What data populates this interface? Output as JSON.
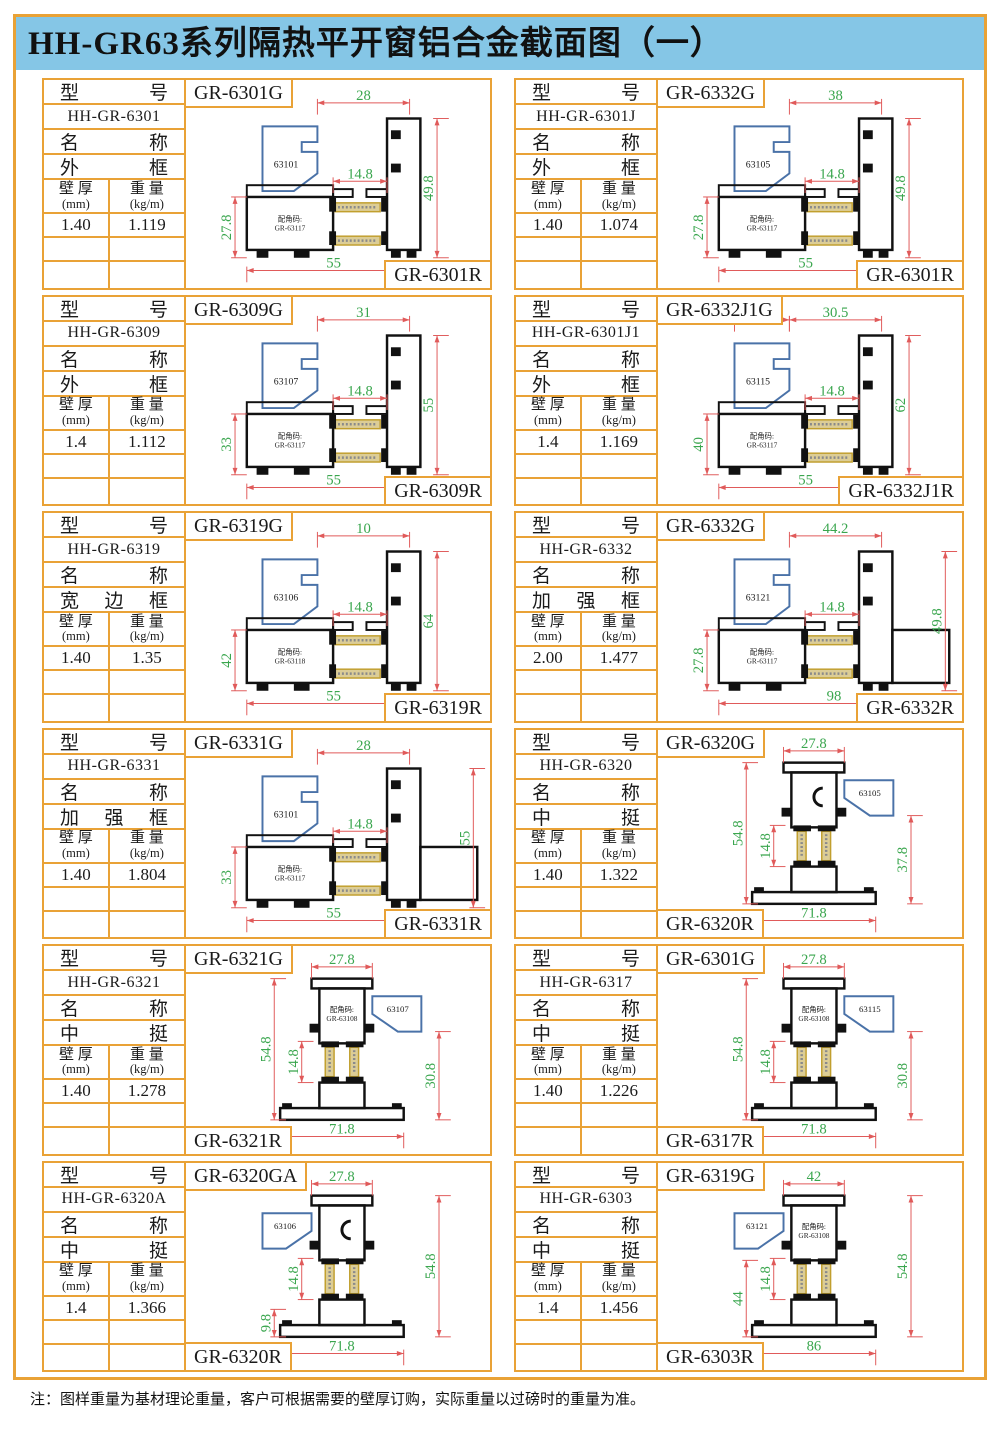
{
  "title": "HH-GR63系列隔热平开窗铝合金截面图（一）",
  "note": "注：图样重量为基材理论重量，客户可根据需要的壁厚订购，实际重量以过磅时的重量为准。",
  "table_labels": {
    "model": "型 号",
    "name": "名 称",
    "thickness_line1": "壁 厚",
    "thickness_unit": "(mm)",
    "weight_line1": "重 量",
    "weight_unit": "(kg/m)"
  },
  "drawing_labels": {
    "corner_label": "配角码:"
  },
  "colors": {
    "border": "#E9A236",
    "title_bg": "#85C6E6",
    "text": "#1a1a1a",
    "profile": "#111111",
    "bead": "#4A72A8",
    "dim_line": "#E05A5A",
    "dim_text": "#3AA64E",
    "thermo_fill": "#DCCD96",
    "thermo_stroke": "#C19F2E",
    "thermo_dots": "#8A8A8A"
  },
  "cells": [
    {
      "model": "HH-GR-6301",
      "name": "外 框",
      "thickness": "1.40",
      "weight": "1.119",
      "g_label": "GR-6301G",
      "r_label": "GR-6301R",
      "r_pos": "right",
      "drawing": {
        "type": "frame",
        "bead_label": "63101",
        "bead_side": "left",
        "corner_code": "GR-63117",
        "dims": {
          "top": "28",
          "mid": "14.8",
          "left": "27.8",
          "right": "49.8",
          "bottom": "55"
        }
      }
    },
    {
      "model": "HH-GR-6301J",
      "name": "外 框",
      "thickness": "1.40",
      "weight": "1.074",
      "g_label": "GR-6332G",
      "r_label": "GR-6301R",
      "r_pos": "right",
      "drawing": {
        "type": "frame",
        "bead_label": "63105",
        "bead_side": "left",
        "corner_code": "GR-63117",
        "dims": {
          "top": "38",
          "mid": "14.8",
          "left": "27.8",
          "right": "49.8",
          "bottom": "55"
        }
      }
    },
    {
      "model": "HH-GR-6309",
      "name": "外 框",
      "thickness": "1.4",
      "weight": "1.112",
      "g_label": "GR-6309G",
      "r_label": "GR-6309R",
      "r_pos": "right",
      "drawing": {
        "type": "frame",
        "bead_label": "63107",
        "bead_side": "left",
        "corner_code": "GR-63117",
        "dims": {
          "top": "31",
          "mid": "14.8",
          "left": "33",
          "right": "55",
          "bottom": "55"
        }
      }
    },
    {
      "model": "HH-GR-6301J1",
      "name": "外 框",
      "thickness": "1.4",
      "weight": "1.169",
      "g_label": "GR-6332J1G",
      "r_label": "GR-6332J1R",
      "r_pos": "right",
      "drawing": {
        "type": "frame",
        "bead_label": "63115",
        "bead_side": "left",
        "corner_code": "GR-63117",
        "dims": {
          "top": "20",
          "top2": "30.5",
          "mid": "14.8",
          "left": "40",
          "right": "62",
          "bottom": "55"
        }
      }
    },
    {
      "model": "HH-GR-6319",
      "name": "宽 边 框",
      "thickness": "1.40",
      "weight": "1.35",
      "g_label": "GR-6319G",
      "r_label": "GR-6319R",
      "r_pos": "right",
      "drawing": {
        "type": "frame",
        "bead_label": "63106",
        "bead_side": "left",
        "corner_code": "GR-63118",
        "dims": {
          "top": "10",
          "mid": "14.8",
          "left": "42",
          "right": "64",
          "bottom": "55"
        }
      }
    },
    {
      "model": "HH-GR-6332",
      "name": "加 强 框",
      "thickness": "2.00",
      "weight": "1.477",
      "g_label": "GR-6332G",
      "r_label": "GR-6332R",
      "r_pos": "right",
      "drawing": {
        "type": "frame",
        "bead_label": "63121",
        "bead_side": "left",
        "corner_code": "GR-63117",
        "ext": true,
        "bottom_span": "full",
        "dims": {
          "top": "44.2",
          "mid": "14.8",
          "left": "27.8",
          "right": "49.8",
          "bottom": "98"
        }
      }
    },
    {
      "model": "HH-GR-6331",
      "name": "加 强 框",
      "thickness": "1.40",
      "weight": "1.804",
      "g_label": "GR-6331G",
      "r_label": "GR-6331R",
      "r_pos": "right",
      "drawing": {
        "type": "frame",
        "bead_label": "63101",
        "bead_side": "left",
        "corner_code": "GR-63117",
        "ext": true,
        "bottom_span": "main",
        "dims": {
          "top": "28",
          "mid": "14.8",
          "left": "33",
          "right": "55",
          "bottom": "55"
        }
      }
    },
    {
      "model": "HH-GR-6320",
      "name": "中 挺",
      "thickness": "1.40",
      "weight": "1.322",
      "g_label": "GR-6320G",
      "r_label": "GR-6320R",
      "r_pos": "left",
      "drawing": {
        "type": "mullion",
        "bead_label": "63105",
        "bead_side": "right",
        "left_style": "full",
        "right_style": "partial",
        "dims": {
          "top": "27.8",
          "mid": "14.8",
          "left": "54.8",
          "right": "37.8",
          "bottom": "71.8"
        }
      }
    },
    {
      "model": "HH-GR-6321",
      "name": "中 挺",
      "thickness": "1.40",
      "weight": "1.278",
      "g_label": "GR-6321G",
      "r_label": "GR-6321R",
      "r_pos": "left",
      "drawing": {
        "type": "mullion",
        "bead_label": "63107",
        "bead_side": "right",
        "corner_code": "GR-63108",
        "left_style": "full",
        "right_style": "partial",
        "dims": {
          "top": "27.8",
          "mid": "14.8",
          "left": "54.8",
          "right": "30.8",
          "bottom": "71.8"
        }
      }
    },
    {
      "model": "HH-GR-6317",
      "name": "中 挺",
      "thickness": "1.40",
      "weight": "1.226",
      "g_label": "GR-6301G",
      "r_label": "GR-6317R",
      "r_pos": "left",
      "drawing": {
        "type": "mullion",
        "bead_label": "63115",
        "bead_side": "right",
        "corner_code": "GR-63108",
        "left_style": "full",
        "right_style": "partial",
        "dims": {
          "top": "27.8",
          "mid": "14.8",
          "left": "54.8",
          "right": "30.8",
          "bottom": "71.8"
        }
      }
    },
    {
      "model": "HH-GR-6320A",
      "name": "中 挺",
      "thickness": "1.4",
      "weight": "1.366",
      "g_label": "GR-6320GA",
      "r_label": "GR-6320R",
      "r_pos": "left",
      "drawing": {
        "type": "mullion",
        "bead_label": "63106",
        "bead_side": "left",
        "left_style": "small",
        "right_style": "full",
        "dims": {
          "top": "27.8",
          "mid": "14.8",
          "left": "9.8",
          "right": "54.8",
          "bottom": "71.8"
        }
      }
    },
    {
      "model": "HH-GR-6303",
      "name": "中 挺",
      "thickness": "1.4",
      "weight": "1.456",
      "g_label": "GR-6319G",
      "r_label": "GR-6303R",
      "r_pos": "left",
      "drawing": {
        "type": "mullion",
        "bead_label": "63121",
        "bead_side": "left",
        "corner_code": "GR-63108",
        "left_style": "partial",
        "right_style": "full",
        "dims": {
          "top": "42",
          "mid": "14.8",
          "left": "44",
          "right": "54.8",
          "bottom": "86"
        }
      }
    }
  ]
}
